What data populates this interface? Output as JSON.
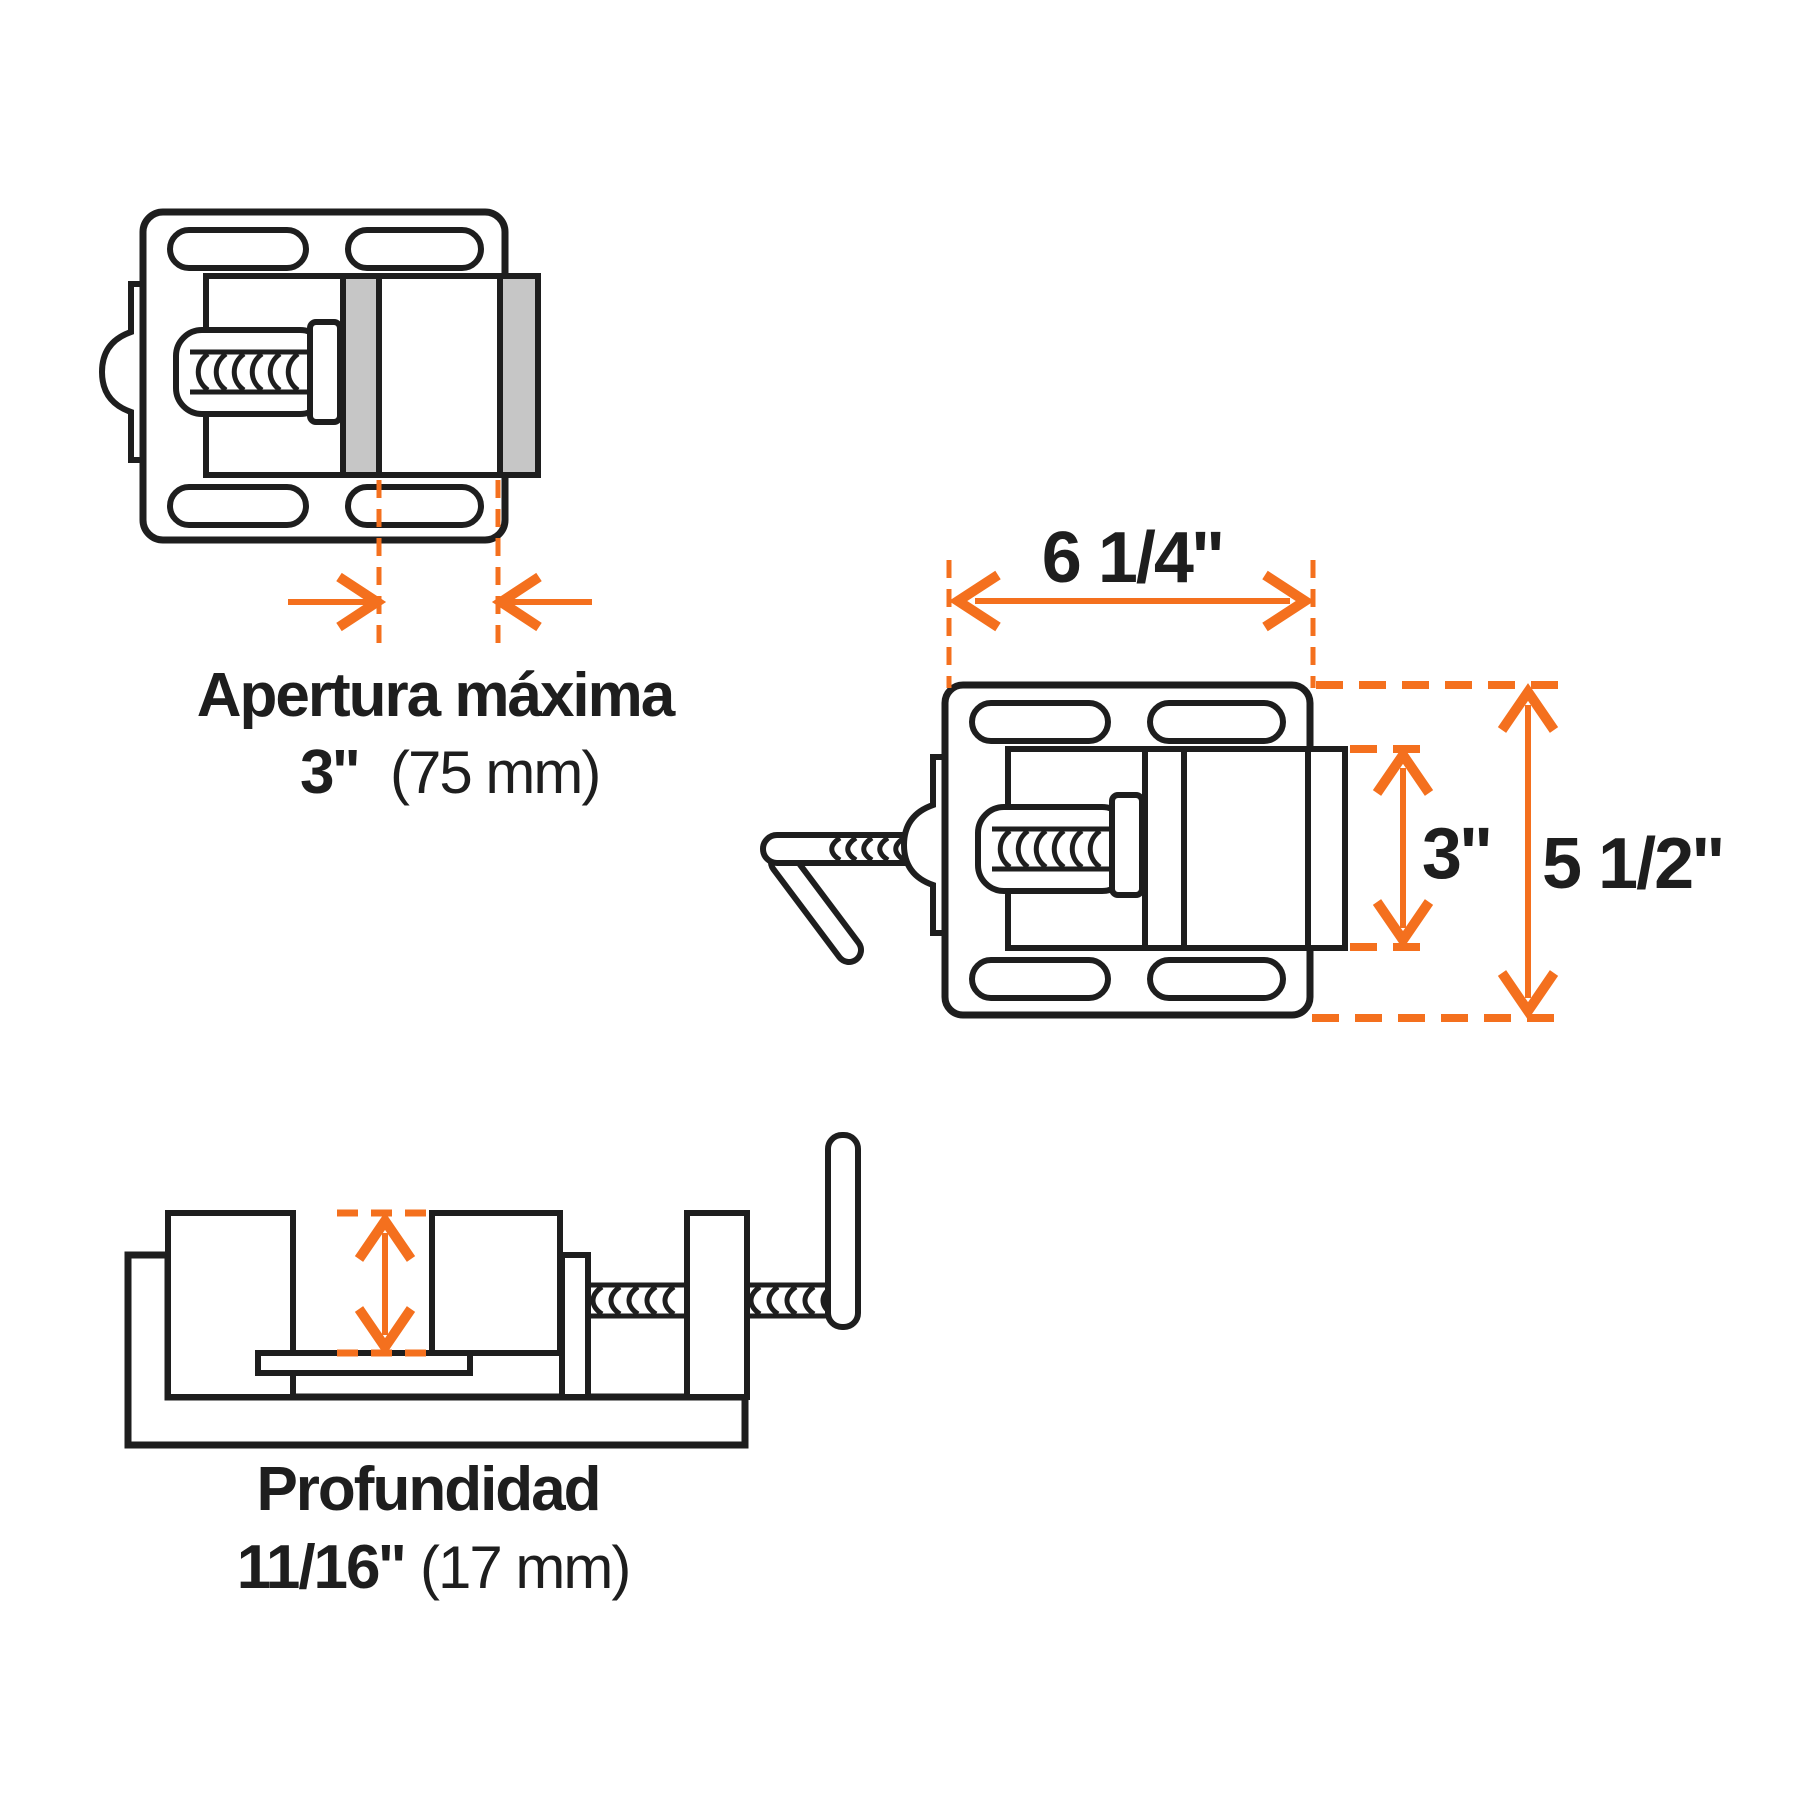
{
  "colors": {
    "accent": "#F4701E",
    "line": "#1E1E1E",
    "jaw_fill": "#C6C6C6"
  },
  "views": {
    "apertura": {
      "title": "Apertura máxima",
      "value": "3''",
      "metric": "(75 mm)"
    },
    "dims": {
      "width": "6 1/4''",
      "opening": "3''",
      "height": "5 1/2''"
    },
    "profundidad": {
      "title": "Profundidad",
      "value": "11/16''",
      "metric": "(17 mm)"
    }
  }
}
